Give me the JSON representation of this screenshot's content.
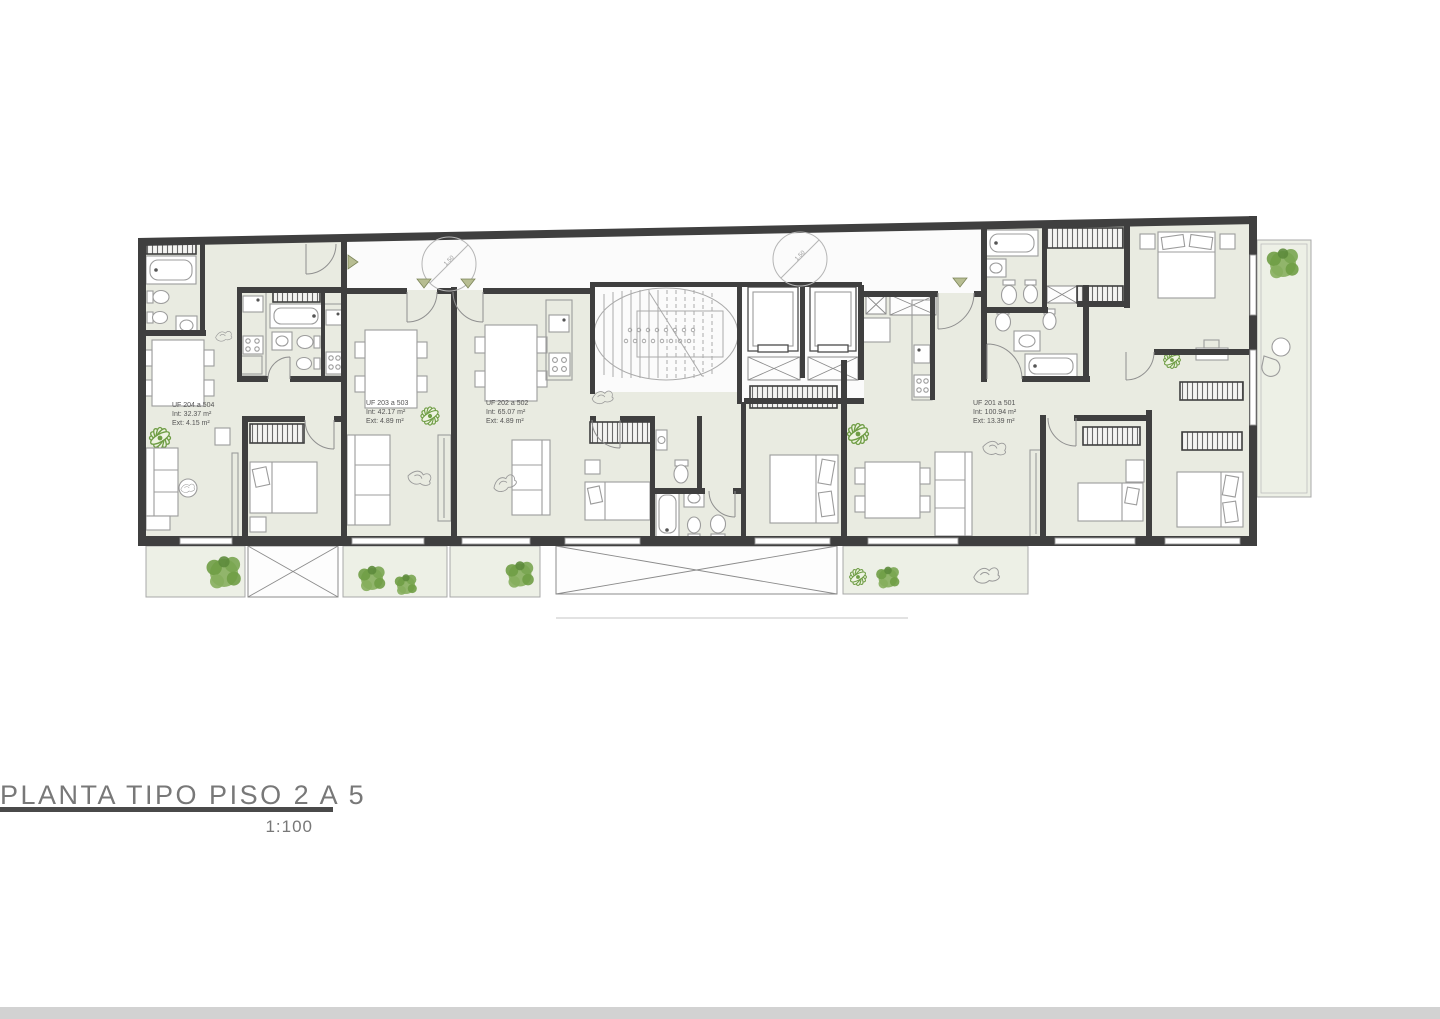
{
  "page": {
    "title": "PLANTA TIPO PISO 2 A 5",
    "scale_label": "1:100"
  },
  "plan": {
    "turning_radius_label": "1.50",
    "units": [
      {
        "id": "UF 204 a 504",
        "interior": "Int: 32.37 m²",
        "exterior": "Ext: 4.15 m²"
      },
      {
        "id": "UF 203 a 503",
        "interior": "Int: 42.17 m²",
        "exterior": "Ext: 4.89 m²"
      },
      {
        "id": "UF 202 a 502",
        "interior": "Int: 65.07 m²",
        "exterior": "Ext: 4.89 m²"
      },
      {
        "id": "UF 201 a 501",
        "interior": "Int: 100.94 m²",
        "exterior": "Ext: 13.39 m²"
      }
    ]
  },
  "colors": {
    "wall": "#3f3f3f",
    "floor": "#e9ebe1",
    "corridor": "#fbfbfb",
    "balcony": "#edf0e6",
    "furniture": "#9c9c9c",
    "fixture_dark": "#4a4a4a",
    "plant": "#6f9d45",
    "plant_light": "#86ae5d",
    "triangle": "#b7bd92",
    "triangle_edge": "#7c8559",
    "label": "#555555",
    "title": "#787878",
    "underline": "#4a4a4a",
    "footer": "#d2d2d2",
    "page_bg": "#ffffff"
  }
}
